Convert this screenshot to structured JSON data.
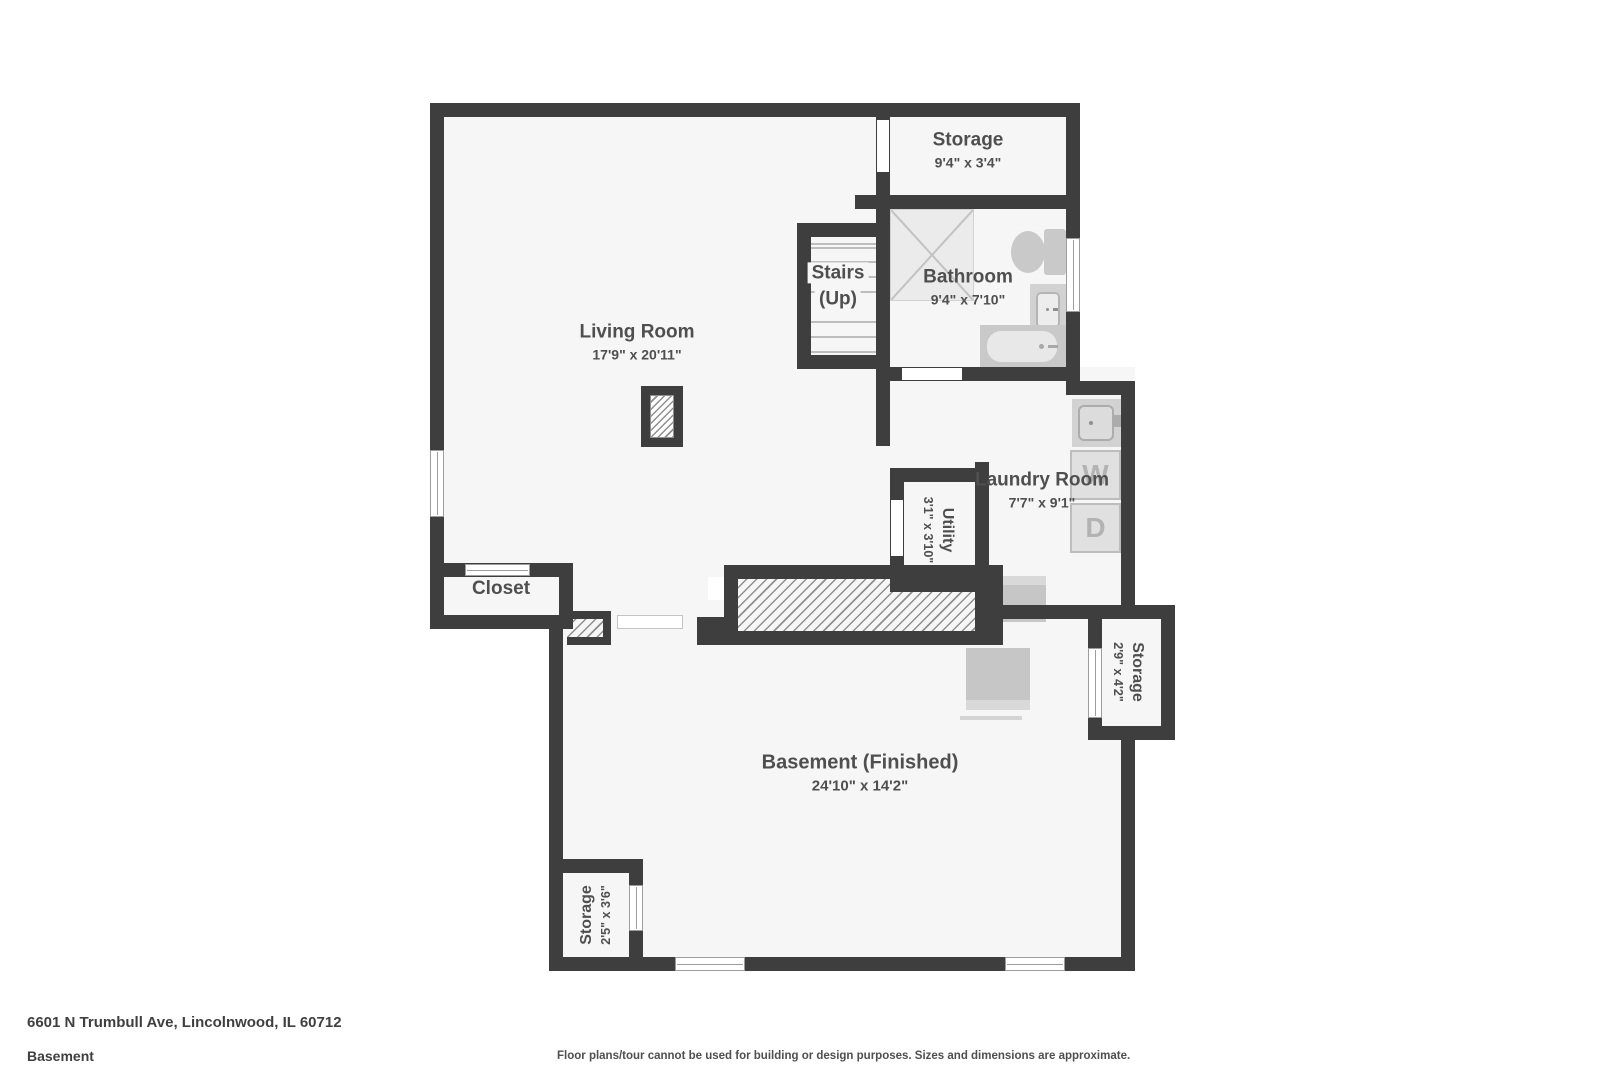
{
  "plan": {
    "rooms": {
      "storage_top": {
        "name": "Storage",
        "dims": "9'4\" x 3'4\""
      },
      "bathroom": {
        "name": "Bathroom",
        "dims": "9'4\" x 7'10\""
      },
      "stairs": {
        "name": "Stairs",
        "direction": "(Up)"
      },
      "living_room": {
        "name": "Living Room",
        "dims": "17'9\" x 20'11\""
      },
      "laundry": {
        "name": "Laundry Room",
        "dims": "7'7\" x 9'1\""
      },
      "utility": {
        "name": "Utility",
        "dims": "3'1\" x 3'10\""
      },
      "closet": {
        "name": "Closet"
      },
      "storage_right": {
        "name": "Storage",
        "dims": "2'9\" x 4'2\""
      },
      "basement": {
        "name": "Basement (Finished)",
        "dims": "24'10\" x 14'2\""
      },
      "storage_bottom": {
        "name": "Storage",
        "dims": "2'5\" x 3'6\""
      }
    },
    "appliances": {
      "washer": "W",
      "dryer": "D"
    },
    "colors": {
      "wall": "#3e3e3e",
      "floor": "#f6f6f6",
      "fixture": "#c9c9c9",
      "label": "#4f4f4f"
    }
  },
  "footer": {
    "address": "6601 N Trumbull Ave, Lincolnwood, IL 60712",
    "floor": "Basement",
    "disclaimer": "Floor plans/tour cannot be used for building or design purposes. Sizes and dimensions are approximate."
  }
}
